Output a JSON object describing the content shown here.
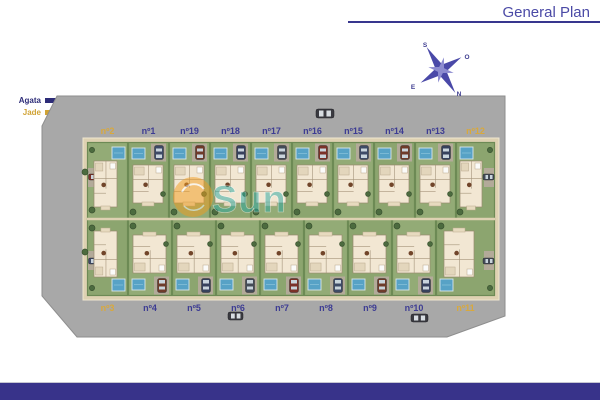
{
  "header": {
    "title": "General Plan",
    "accent_color": "#4b4aa6"
  },
  "legend": {
    "items": [
      {
        "label": "Agata",
        "color": "#2d2c78"
      },
      {
        "label": "Jade",
        "color": "#d0a335"
      }
    ]
  },
  "compass": {
    "top": "S",
    "upper_right": "O",
    "lower_left": "E",
    "lower_right": "N"
  },
  "watermark": {
    "text": "Sun",
    "text_color": "#2ba9a2",
    "sun_color": "#f29c1e"
  },
  "plan": {
    "top_row": [
      {
        "label": "nº2",
        "model": "jade"
      },
      {
        "label": "nº1",
        "model": "agata"
      },
      {
        "label": "nº19",
        "model": "agata"
      },
      {
        "label": "nº18",
        "model": "agata"
      },
      {
        "label": "nº17",
        "model": "agata"
      },
      {
        "label": "nº16",
        "model": "agata"
      },
      {
        "label": "nº15",
        "model": "agata"
      },
      {
        "label": "nº14",
        "model": "agata"
      },
      {
        "label": "nº13",
        "model": "agata"
      },
      {
        "label": "nº12",
        "model": "jade"
      }
    ],
    "bottom_row": [
      {
        "label": "nº3",
        "model": "jade"
      },
      {
        "label": "nº4",
        "model": "agata"
      },
      {
        "label": "nº5",
        "model": "agata"
      },
      {
        "label": "nº6",
        "model": "agata"
      },
      {
        "label": "nº7",
        "model": "agata"
      },
      {
        "label": "nº8",
        "model": "agata"
      },
      {
        "label": "nº9",
        "model": "agata"
      },
      {
        "label": "nº10",
        "model": "agata"
      },
      {
        "label": "nº11",
        "model": "jade"
      }
    ],
    "palette": {
      "road": "#a8a8a8",
      "road_edge": "#8e8e8e",
      "sidewalk": "#ded1b2",
      "sidewalk_edge": "#efe6cf",
      "lawn_a": "#8ca56f",
      "lawn_b": "#93ab76",
      "hedge": "#6d8a55",
      "pool": "#57a2c6",
      "pool_edge": "#d9e6ec",
      "house": "#f2e7d3",
      "house_edge": "#998a6e",
      "driveway": "#b3aa99",
      "label_agata": "#3d3c93",
      "label_jade": "#d9a93c",
      "car_colors": [
        "#7b3128",
        "#3e4a66",
        "#6e3b2a",
        "#37415c",
        "#444b57"
      ]
    }
  }
}
